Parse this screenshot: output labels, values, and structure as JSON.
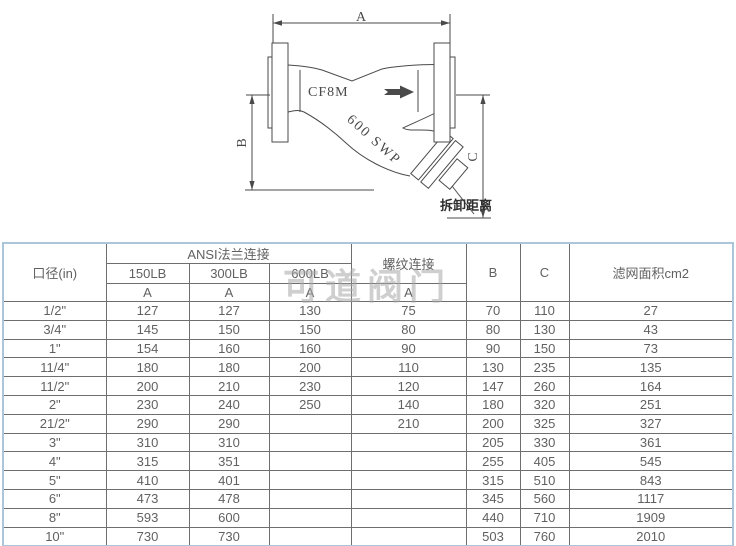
{
  "colors": {
    "table_outer_border": "#a9c6da",
    "table_grid": "#6e6e6e",
    "table_text": "#616161",
    "drawing_line": "#4a4a4a",
    "watermark_gray": "#a8a8a8"
  },
  "watermark": "可道阀门",
  "diagram": {
    "labels": {
      "dim_a": "A",
      "dim_b": "B",
      "dim_c": "C",
      "body_material": "CF8M",
      "rating": "600 SWP",
      "removal_distance": "拆卸距离"
    }
  },
  "table": {
    "headers": {
      "diameter": "口径(in)",
      "ansi_flange": "ANSI法兰连接",
      "threaded": "螺纹连接",
      "b": "B",
      "c": "C",
      "screen_area": "滤网面积cm2",
      "lb150": "150LB",
      "lb300": "300LB",
      "lb600": "600LB",
      "a": "A"
    },
    "rows": [
      [
        "1/2\"",
        "127",
        "127",
        "130",
        "75",
        "70",
        "110",
        "27"
      ],
      [
        "3/4\"",
        "145",
        "150",
        "150",
        "80",
        "80",
        "130",
        "43"
      ],
      [
        "1\"",
        "154",
        "160",
        "160",
        "90",
        "90",
        "150",
        "73"
      ],
      [
        "11/4\"",
        "180",
        "180",
        "200",
        "110",
        "130",
        "235",
        "135"
      ],
      [
        "11/2\"",
        "200",
        "210",
        "230",
        "120",
        "147",
        "260",
        "164"
      ],
      [
        "2\"",
        "230",
        "240",
        "250",
        "140",
        "180",
        "320",
        "251"
      ],
      [
        "21/2\"",
        "290",
        "290",
        "",
        "210",
        "200",
        "325",
        "327"
      ],
      [
        "3\"",
        "310",
        "310",
        "",
        "",
        "205",
        "330",
        "361"
      ],
      [
        "4\"",
        "315",
        "351",
        "",
        "",
        "255",
        "405",
        "545"
      ],
      [
        "5\"",
        "410",
        "401",
        "",
        "",
        "315",
        "510",
        "843"
      ],
      [
        "6\"",
        "473",
        "478",
        "",
        "",
        "345",
        "560",
        "1117"
      ],
      [
        "8\"",
        "593",
        "600",
        "",
        "",
        "440",
        "710",
        "1909"
      ],
      [
        "10\"",
        "730",
        "730",
        "",
        "",
        "503",
        "760",
        "2010"
      ]
    ]
  }
}
